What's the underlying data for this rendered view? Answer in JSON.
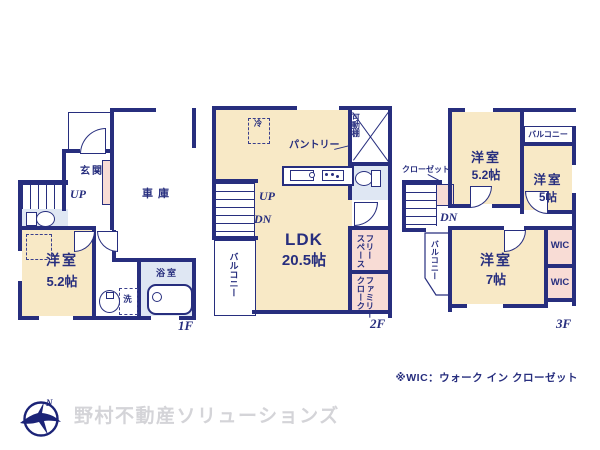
{
  "colors": {
    "wall_navy": "#272e7e",
    "room_cream": "#f8e9c6",
    "closet_pink": "#f8dcd5",
    "bath_blue": "#dfe7f3",
    "logo_navy": "#1b2377",
    "company_gray": "#d4d4d8"
  },
  "floor1": {
    "label": "1F",
    "entrance": "玄関",
    "garage": "車庫",
    "stairs_up": "UP",
    "bedroom": "洋室",
    "bedroom_size": "5.2帖",
    "bathroom": "浴室",
    "laundry": "洗"
  },
  "floor2": {
    "label": "2F",
    "fridge": "冷",
    "pantry": "パントリー",
    "shelf": "可動棚",
    "stairs_up": "UP",
    "stairs_down": "DN",
    "ldk": "LDK",
    "ldk_size": "20.5帖",
    "balcony": "バルコニー",
    "free_space_col1": "フリー",
    "free_space_col2": "スペース",
    "family_closet_col1": "ファミリー",
    "family_closet_col2": "クローク"
  },
  "floor3": {
    "label": "3F",
    "bedroom1": "洋室",
    "bedroom1_size": "5.2帖",
    "balcony_top": "バルコニー",
    "bedroom2": "洋室",
    "bedroom2_size": "5帖",
    "closet": "クローゼット",
    "stairs_down": "DN",
    "balcony_left": "バルコニー",
    "bedroom3": "洋室",
    "bedroom3_size": "7帖",
    "wic1": "WIC",
    "wic2": "WIC"
  },
  "footer": {
    "note": "※WIC：ウォーク イン クローゼット",
    "company": "野村不動産ソリューションズ"
  }
}
